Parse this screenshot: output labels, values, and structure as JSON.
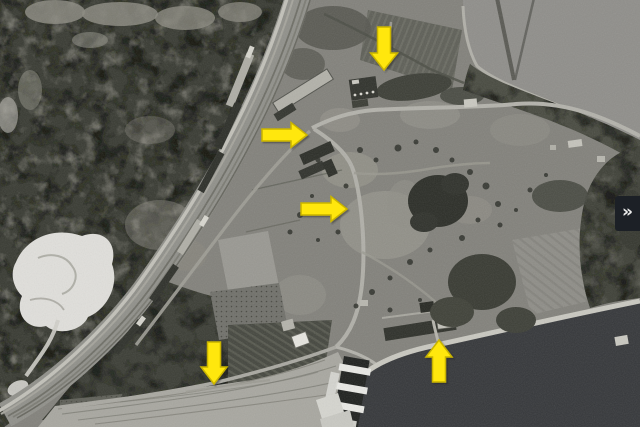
{
  "viewer": {
    "width": 640,
    "height": 427,
    "content": "grayscale-aerial-photograph"
  },
  "panel_toggle": {
    "glyph": "»",
    "icon": "double-chevron-right",
    "bg_color": "#1c2026",
    "fg_color": "#ededed"
  },
  "annotations": {
    "arrow_fill": "#ffe70a",
    "arrow_outline": "#c9b400",
    "arrows": [
      {
        "id": "top-center",
        "direction": "down",
        "tip_x": 384,
        "tip_y": 70,
        "length": 43,
        "shaft_width": 13,
        "head_width": 27,
        "head_length": 17
      },
      {
        "id": "mid-left",
        "direction": "right",
        "tip_x": 307,
        "tip_y": 135,
        "length": 45,
        "shaft_width": 12,
        "head_width": 25,
        "head_length": 16
      },
      {
        "id": "center",
        "direction": "right",
        "tip_x": 347,
        "tip_y": 209,
        "length": 46,
        "shaft_width": 12,
        "head_width": 25,
        "head_length": 16
      },
      {
        "id": "bottom-left",
        "direction": "down",
        "tip_x": 214,
        "tip_y": 384,
        "length": 42,
        "shaft_width": 13,
        "head_width": 26,
        "head_length": 17
      },
      {
        "id": "bottom-right",
        "direction": "up",
        "tip_x": 439,
        "tip_y": 340,
        "length": 42,
        "shaft_width": 13,
        "head_width": 26,
        "head_length": 17
      }
    ]
  },
  "scene": {
    "base": "#82817b",
    "forest": "#383a32",
    "water_north": "#8f8e8a",
    "water_south": "#35373a",
    "railway": "#90908a",
    "terrace": "#a8a7a0",
    "quarry": "#e0dfdb"
  }
}
